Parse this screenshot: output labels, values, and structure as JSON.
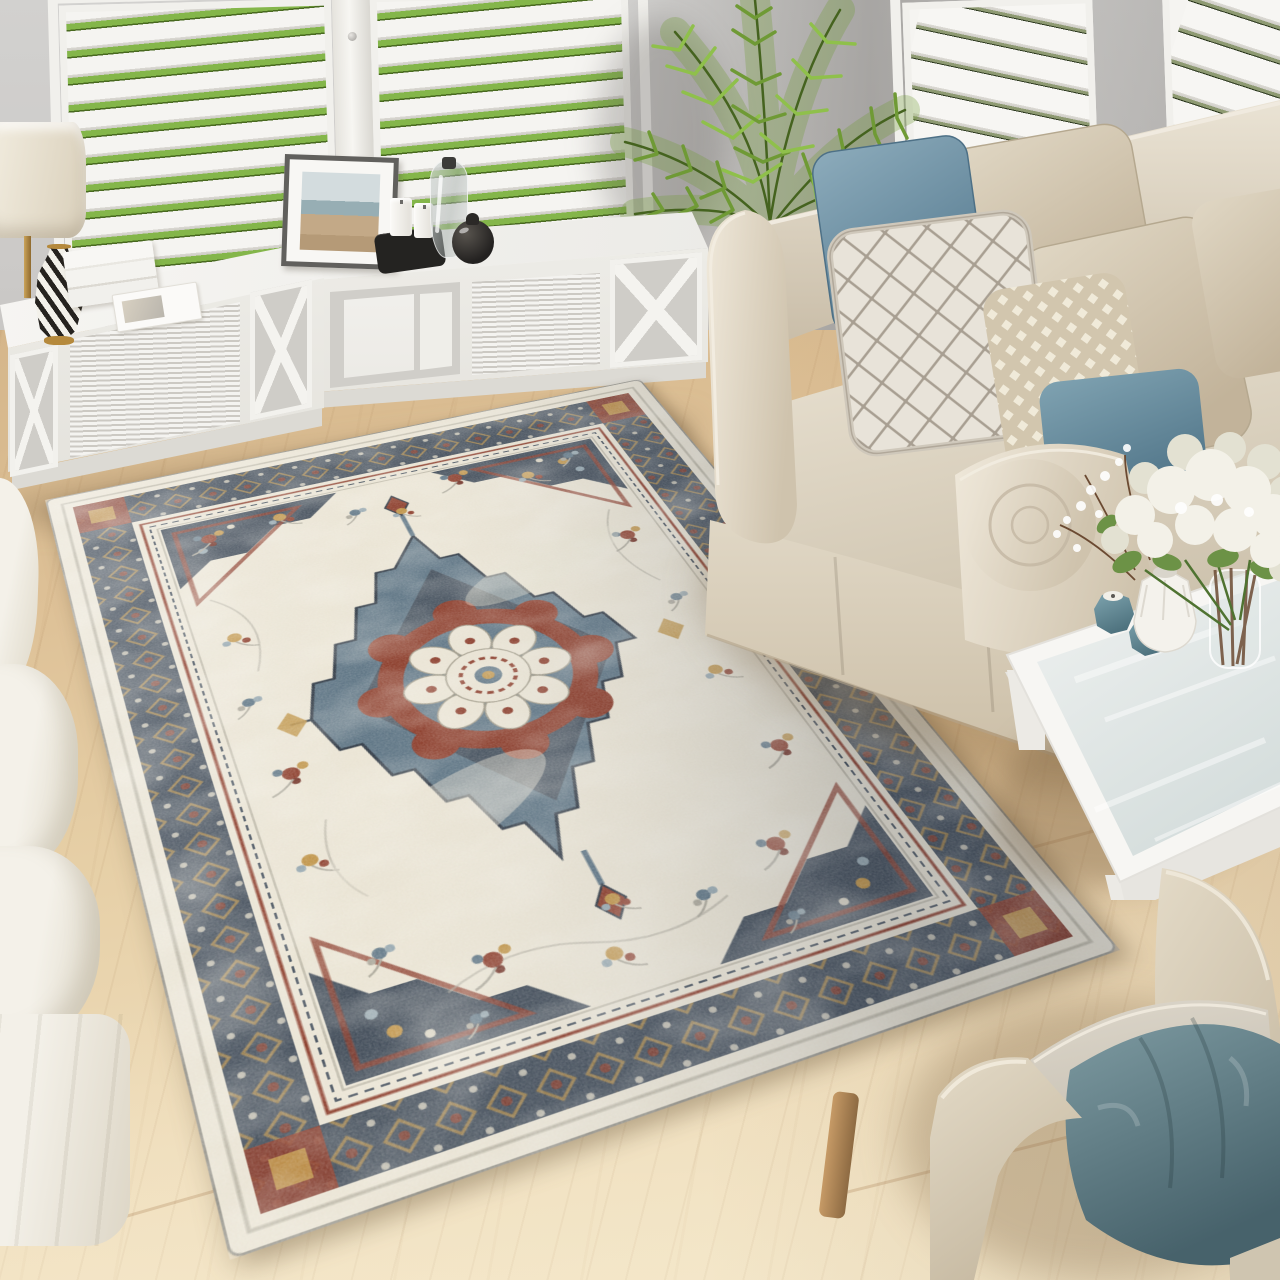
{
  "scene": {
    "description": "Bright coastal living room photograph: a vintage Persian-style medallion area rug in cream, navy blue and rust lies on light oak flooring between a beige slip-covered roll-arm sofa with blue and diamond-pattern pillows, a white TV console with X-brace shelves under white plantation shutters, a potted areca palm, a white glass-top coffee table holding white hydrangeas and teal candle holders, an ivory sofa at the left edge, and a beige armchair with a teal crinkle pillow at the lower right."
  },
  "objects": {
    "room": {
      "label": "Bright living room scene"
    },
    "wall": {
      "label": "Light gray wall"
    },
    "floor": {
      "label": "Light oak wood floor"
    },
    "shuttersLeft": {
      "label": "White plantation shutter windows with garden greenery"
    },
    "shuttersRight": {
      "label": "White plantation shutter windows behind sofa"
    },
    "palm": {
      "label": "Potted areca palm plant"
    },
    "console": {
      "label": "White TV console with X-brace open shelves"
    },
    "lamp": {
      "label": "Table lamp with cream drum shade"
    },
    "chevronVase": {
      "label": "Black and white chevron vase with gold base"
    },
    "books": {
      "label": "Stack of white coffee-table books"
    },
    "magazine": {
      "label": "White magazine"
    },
    "photoFrame": {
      "label": "Framed beach photograph"
    },
    "candleTray": {
      "label": "Black tray with white pillar candles"
    },
    "glassVase": {
      "label": "Clear glass bottle vase"
    },
    "blackJar": {
      "label": "Round black ceramic jar"
    },
    "magazineStacks": {
      "label": "Stacked magazines on console shelf"
    },
    "boxFiles": {
      "label": "White storage boxes on console shelf"
    },
    "rug": {
      "label": "Vintage cream, navy and rust medallion area rug"
    },
    "medallion": {
      "label": "Central stepped diamond medallion with cream rosette"
    },
    "sofa": {
      "label": "Beige slipcovered roll-arm sofa"
    },
    "pillowBlue": {
      "label": "Slate blue throw pillow"
    },
    "pillowDiamond": {
      "label": "Cream diamond-lattice throw pillow"
    },
    "pillowBeigeA": {
      "label": "Beige linen throw pillow"
    },
    "pillowBeigeB": {
      "label": "Beige linen throw pillow"
    },
    "pillowSquare": {
      "label": "Beige geometric-print throw pillow"
    },
    "pillowBlueRight": {
      "label": "Blue throw pillow by sofa arm"
    },
    "coffeeTable": {
      "label": "White coffee table with glass top"
    },
    "candleHolders": {
      "label": "Teal faceted candle holders"
    },
    "whiteVase": {
      "label": "White faceted vase"
    },
    "twigVase": {
      "label": "Glass vase with branch stems"
    },
    "bouquet": {
      "label": "White hydrangea bouquet"
    },
    "armchair": {
      "label": "Beige roll-arm armchair"
    },
    "armchairPillow": {
      "label": "Teal crinkle throw pillow"
    },
    "armchairLeg": {
      "label": "Wooden armchair leg"
    },
    "leftSofa": {
      "label": "Ivory slipcovered sofa at left edge"
    }
  },
  "colors": {
    "wall": "#cfcdcb",
    "wall-dark": "#a9a6a3",
    "shutter": "#f5f4f1",
    "frame-white": "#f1f0ec",
    "garden": "#84b64a",
    "garden-dark": "#4e7426",
    "floor-a": "#d5b68a",
    "floor-b": "#e6cfa6",
    "floor-c": "#f1e4c6",
    "seam": "#a97f52",
    "palm-hi": "#8fc04b",
    "palm-mid": "#6f9a35",
    "palm-dark": "#45631f",
    "cane": "#a8a55e",
    "sofa-hi": "#eae3d4",
    "sofa-mid": "#d6cbb7",
    "sofa-low": "#b3a68f",
    "skirt-lo": "#c6b89f",
    "pillow-blue-hi": "#8cabbb",
    "pillow-blue-lo": "#597d92",
    "diamond-bg": "#e8e3d9",
    "diamond-line": "#a89f92",
    "sq-bg": "#d2c6ae",
    "sq-fg": "#f0ead9",
    "teal-hi": "#7d9aa1",
    "teal-lo": "#47626b",
    "leftsofa-hi": "#f4f1e9",
    "leftsofa-lo": "#ded8c8",
    "table-white": "#f7f6f3",
    "glass-hi": "#eef1f0",
    "glass-lo": "#d3dcdb",
    "candle-teal-hi": "#7fa5b0",
    "candle-teal-lo": "#4f737f",
    "flower-hi": "#f3f1e8",
    "flower-lo": "#e3e1d2",
    "leaf": "#6c9246",
    "leaf-dark": "#4f7331",
    "twig": "#6b4a32",
    "lamp-hi": "#f3eee1",
    "lamp-lo": "#d9cfba",
    "brass": "#b5893c",
    "jar": "#232120",
    "tray": "#242321",
    "chevron": "#26231f",
    "chevron-bg": "#f3f1ea",
    "photo-sky": "#d3dcde",
    "photo-sea": "#97aeb4",
    "photo-sand": "#c3a987",
    "frame-gray": "#61605d",
    "mat": "#f8f7f4",
    "rug-cream": "#e9e3d3",
    "rug-cream2": "#ddd5c2",
    "rug-edge": "#8f8d84",
    "rug-navy": "#414c59",
    "rug-navy-dark": "#2d3743",
    "rug-slate": "#5d7484",
    "rug-slate-light": "#93a5ae",
    "rug-rust": "#8a3a28",
    "rug-maroon": "#6e2c20",
    "rug-gold": "#bf9347",
    "rug-gray": "#aaa699",
    "leg-hi": "#c69a66",
    "leg-lo": "#8d6a42"
  }
}
